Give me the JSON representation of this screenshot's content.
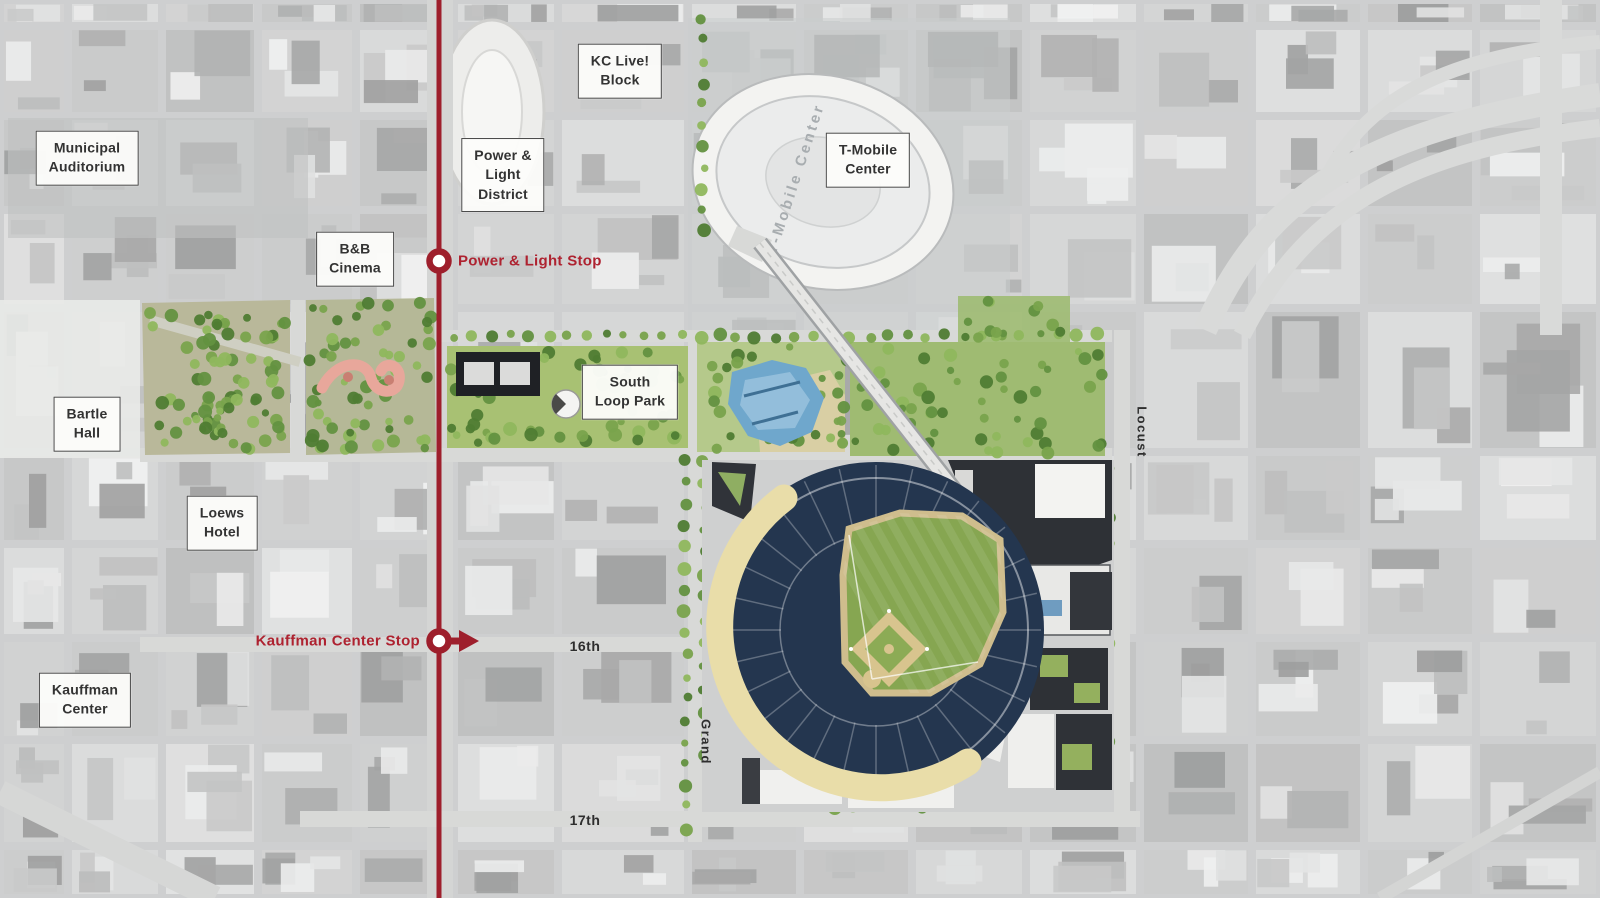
{
  "labels": {
    "municipal_auditorium": "Municipal\nAuditorium",
    "kc_live_block": "KC Live!\nBlock",
    "power_light_district": "Power &\nLight\nDistrict",
    "t_mobile_center": "T-Mobile\nCenter",
    "bb_cinema": "B&B\nCinema",
    "south_loop_park": "South\nLoop Park",
    "bartle_hall": "Bartle\nHall",
    "loews_hotel": "Loews\nHotel",
    "kauffman_center": "Kauffman\nCenter"
  },
  "transit": {
    "stops": [
      {
        "label": "Power & Light Stop"
      },
      {
        "label": "Kauffman Center Stop"
      }
    ]
  },
  "streets": {
    "s16th": "16th",
    "s17th": "17th",
    "grand": "Grand",
    "locust": "Locust"
  },
  "arena": {
    "roof_text": "T-Mobile Center"
  },
  "colors": {
    "transit_red": "#9e1f2c",
    "stop_label_red": "#ae2230",
    "field_green": "#86a651",
    "bowl_navy": "#24364f",
    "concourse_tan": "#e9dda9",
    "park_green": "#a8c173",
    "water_blue": "#6fa7cc"
  }
}
